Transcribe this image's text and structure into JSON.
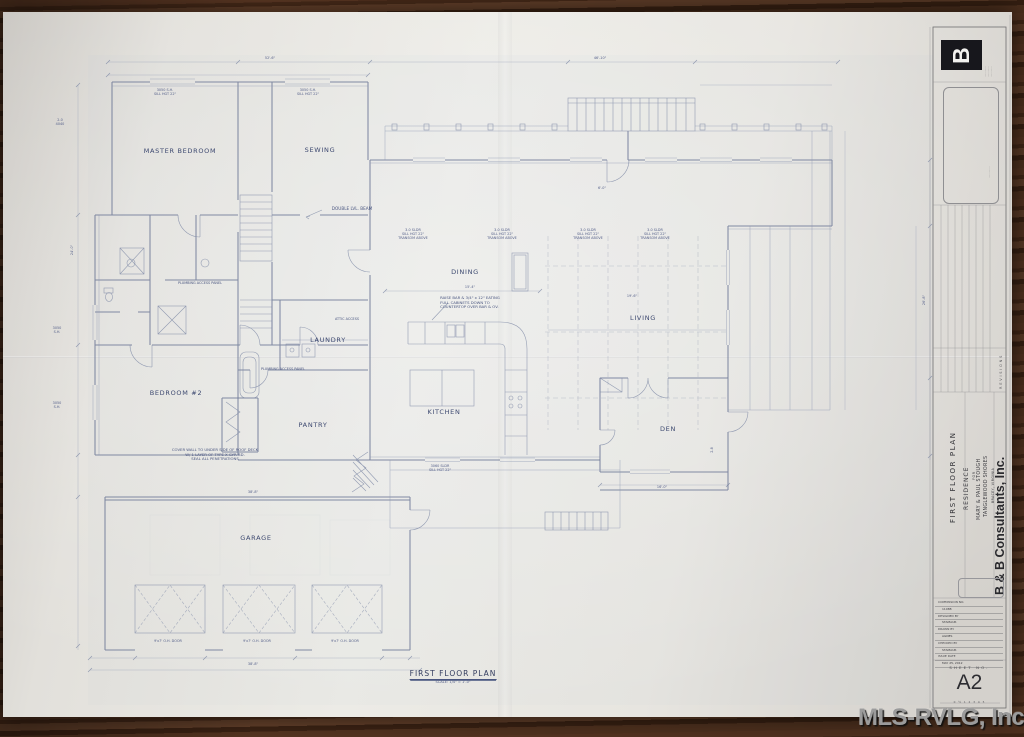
{
  "watermark": {
    "text": "MLS-RVLG, Inc."
  },
  "sheet": {
    "plan_title": "FIRST FLOOR PLAN",
    "plan_scale": "SCALE: 1/4\" = 1'-0\""
  },
  "rooms": {
    "master_bedroom": "MASTER BEDROOM",
    "sewing": "SEWING",
    "dining": "DINING",
    "living": "LIVING",
    "kitchen": "KITCHEN",
    "laundry": "LAUNDRY",
    "pantry": "PANTRY",
    "bedroom2": "BEDROOM #2",
    "garage": "GARAGE",
    "den": "DEN"
  },
  "notes": {
    "double_beam": "DOUBLE LVL. BEAM",
    "raise_bar": "RAISE BAR & 3/4\" x 12\" EATING\nFULL CABINETS DOWN TO\nCOUNTERTOP OVER BAR & OV.",
    "cover_wall": "COVER WALL TO UNDER SIDE OF ROOF DECK\nW/ 1 LAYER OF TYPE X GYP. BD.\nSEAL ALL PENETRATIONS",
    "plumbing_access": "PLUMBING ACCESS PANEL",
    "attic_access": "ATTIC ACCESS"
  },
  "plan": {
    "micro_annotations": [
      {
        "x": 413,
        "y": 234,
        "t": "3-0 SLDR\nSILL HGT 22\"\nTRANSOM ABOVE"
      },
      {
        "x": 502,
        "y": 234,
        "t": "3-0 SLDR\nSILL HGT 22\"\nTRANSOM ABOVE"
      },
      {
        "x": 588,
        "y": 234,
        "t": "3-0 SLDR\nSILL HGT 22\"\nTRANSOM ABOVE"
      },
      {
        "x": 655,
        "y": 234,
        "t": "3-0 SLDR\nSILL HGT 22\"\nTRANSOM ABOVE"
      },
      {
        "x": 165,
        "y": 92,
        "t": "3050 S.H.\nSILL HGT 22\""
      },
      {
        "x": 308,
        "y": 92,
        "t": "3050 S.H.\nSILL HGT 22\""
      },
      {
        "x": 168,
        "y": 641,
        "t": "9'x7' O.H. DOOR"
      },
      {
        "x": 257,
        "y": 641,
        "t": "9'x7' O.H. DOOR"
      },
      {
        "x": 345,
        "y": 641,
        "t": "9'x7' O.H. DOOR"
      },
      {
        "x": 440,
        "y": 468,
        "t": "3060 SLDR\nSILL HGT 22\""
      },
      {
        "x": 470,
        "y": 287,
        "t": "15'-4\""
      },
      {
        "x": 632,
        "y": 296,
        "t": "19'-6\""
      },
      {
        "x": 253,
        "y": 492,
        "t": "38'-8\""
      },
      {
        "x": 253,
        "y": 664,
        "t": "38'-8\""
      },
      {
        "x": 270,
        "y": 58,
        "t": "52'-6\""
      },
      {
        "x": 600,
        "y": 58,
        "t": "46'-10\""
      },
      {
        "x": 72,
        "y": 250,
        "t": "24'-0\"",
        "r": -90
      },
      {
        "x": 924,
        "y": 300,
        "t": "26'-8\"",
        "r": -90
      },
      {
        "x": 712,
        "y": 450,
        "t": "2-8",
        "r": -90
      },
      {
        "x": 60,
        "y": 122,
        "t": "2-0\n4040"
      },
      {
        "x": 57,
        "y": 330,
        "t": "3050\nS.H."
      },
      {
        "x": 57,
        "y": 405,
        "t": "3050\nS.H."
      },
      {
        "x": 602,
        "y": 188,
        "t": "6'-0\""
      },
      {
        "x": 662,
        "y": 487,
        "t": "16'-0\""
      }
    ]
  },
  "title_block": {
    "firm": "B & B Consultants, Inc.",
    "sheet_title": "FIRST FLOOR PLAN",
    "project_type": "RESIDENCE",
    "project_for": "FOR",
    "client": "MARY & PAUL STOUGH",
    "subdivision": "TANGLEWOOD SHORES",
    "location": "BRACEY, VIRGINIA",
    "revisions_label": "REVISIONS",
    "logo_letter": "B",
    "fine_print_logo": "·············\n·············\n·············",
    "fine_print_stamp": "··············",
    "fine_print_firm": "·······························",
    "sheet_no_label": "SHEET NO.",
    "sheet_no": "A2",
    "scale_bar": "0 ½ 1 2 3 4 5",
    "table_rows": [
      "COMMISSION NO.",
      "11088",
      "DESIGNED BY",
      "STAMAUR",
      "DRAWN BY",
      "AGNES",
      "CHECKED BY",
      "STAMAUR",
      "ISSUE DATE",
      "MAY 25, 2012"
    ]
  }
}
